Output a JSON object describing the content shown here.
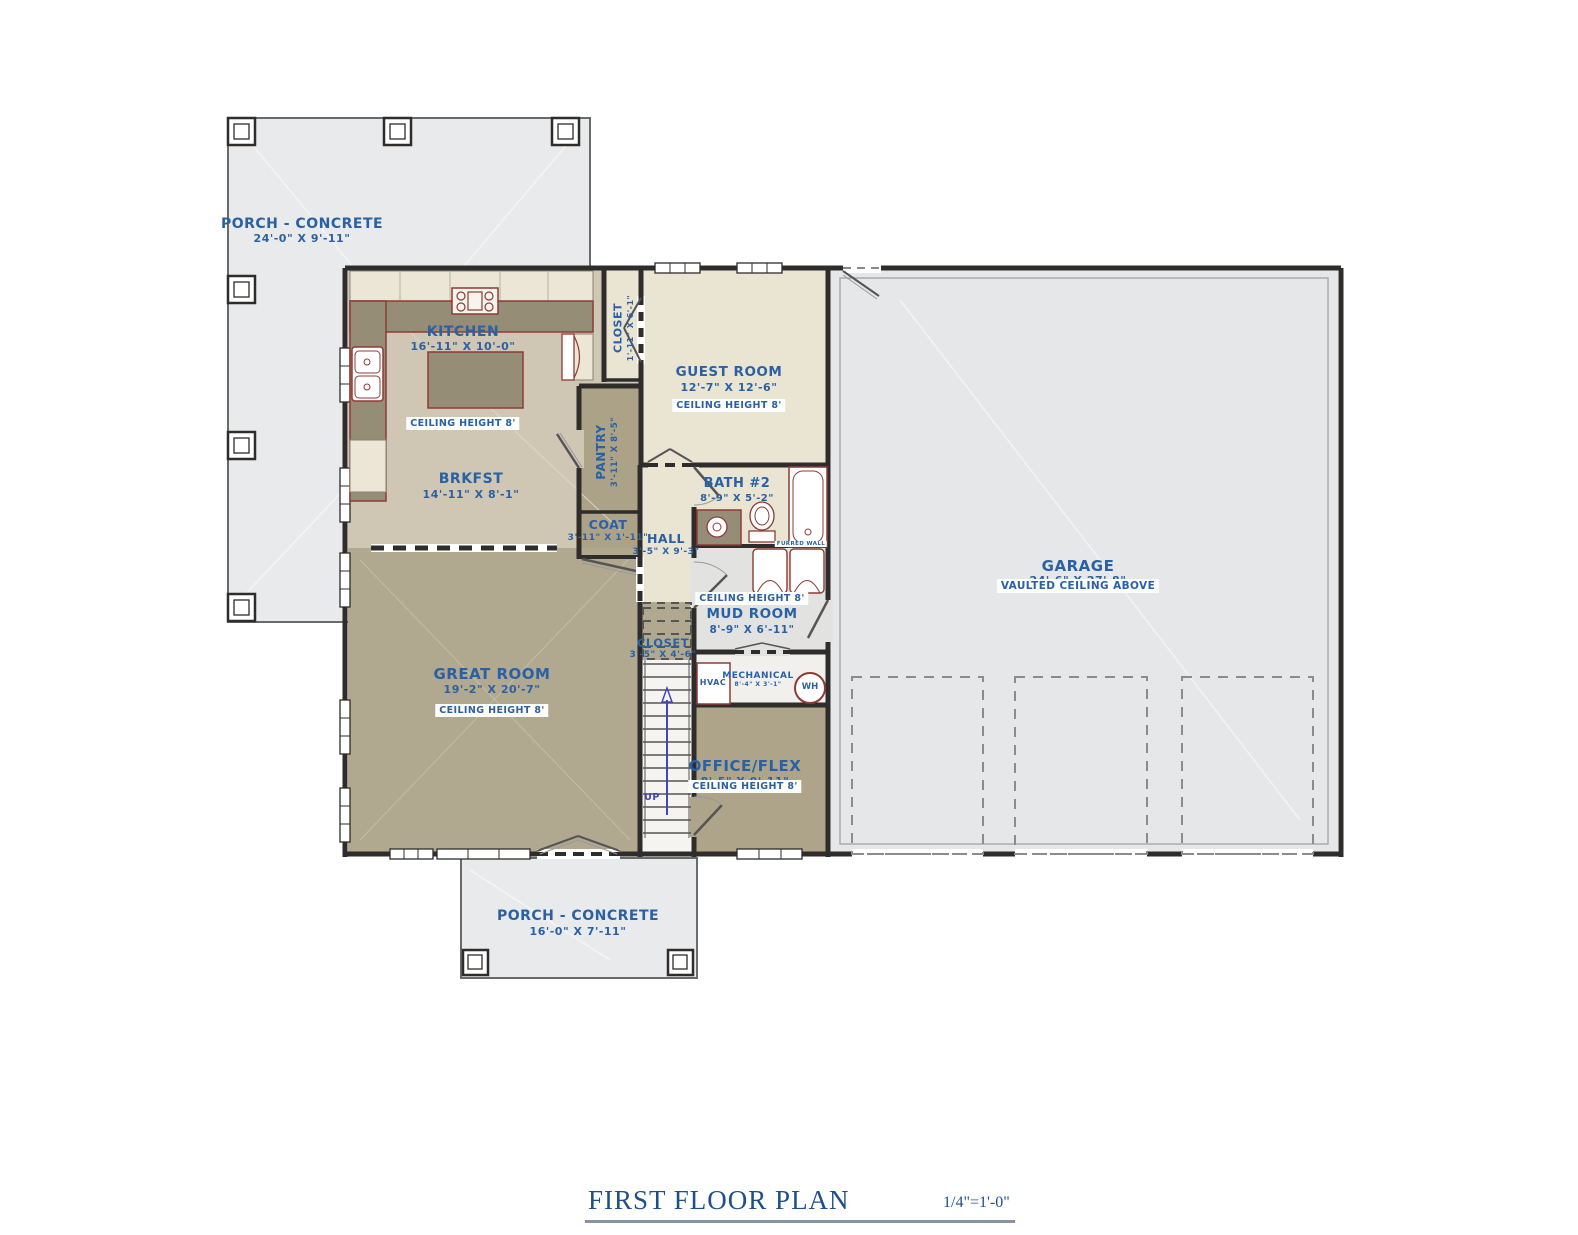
{
  "title": {
    "text": "FIRST FLOOR PLAN",
    "scale": "1/4\"=1'-0\""
  },
  "colors": {
    "label_blue": "#2a61a5",
    "title_navy": "#1d4f8f",
    "wall": "#2e2d2b",
    "fixture_red": "#8e3b34",
    "floor_tan_dark": "#b1a890",
    "floor_tan_light": "#cfc7b4",
    "floor_cream": "#eae4d3",
    "cabinet_cream": "#ece6d6",
    "counter_olive": "#968d77",
    "porch_gray": "#e8eaeb",
    "garage_gray": "#e6e7e8",
    "mud_gray": "#e2e2e1"
  },
  "labels": {
    "porch_top": {
      "name": "PORCH - CONCRETE",
      "dim": "24'-0\" X 9'-11\""
    },
    "kitchen": {
      "name": "KITCHEN",
      "dim": "16'-11\" X 10'-0\"",
      "ceiling": "CEILING HEIGHT 8'"
    },
    "closet_kitchen": {
      "name": "CLOSET",
      "dim": "1'-11\" X 6'-1\""
    },
    "guest_room": {
      "name": "GUEST ROOM",
      "dim": "12'-7\" X 12'-6\"",
      "ceiling": "CEILING HEIGHT 8'"
    },
    "pantry": {
      "name": "PANTRY",
      "dim": "3'-11\" X 8'-5\""
    },
    "brkfst": {
      "name": "BRKFST",
      "dim": "14'-11\" X 8'-1\""
    },
    "bath2": {
      "name": "BATH #2",
      "dim": "8'-9\" X 5'-2\""
    },
    "coat": {
      "name": "COAT",
      "dim": "3'-11\" X 1'-11\""
    },
    "hall": {
      "name": "HALL",
      "dim": "3'-5\" X 9'-3\""
    },
    "furred_wall": {
      "name": "FURRED WALL"
    },
    "garage": {
      "name": "GARAGE",
      "dim": "24'-6\" X 27'-8\"",
      "note": "VAULTED CEILING ABOVE"
    },
    "mud_room": {
      "name": "MUD ROOM",
      "dim": "8'-9\" X 6'-11\"",
      "ceiling": "CEILING HEIGHT 8'"
    },
    "great_room": {
      "name": "GREAT ROOM",
      "dim": "19'-2\" X 20'-7\"",
      "ceiling": "CEILING HEIGHT 8'"
    },
    "closet_stairs": {
      "name": "CLOSET",
      "dim": "3'-5\" X 4'-6\""
    },
    "hvac": {
      "name": "HVAC"
    },
    "mechanical": {
      "name": "MECHANICAL",
      "dim": "8'-4\" X 3'-1\""
    },
    "wh": {
      "name": "WH"
    },
    "office": {
      "name": "OFFICE/FLEX",
      "dim": "8'-5\" X 9'-11\"",
      "ceiling": "CEILING HEIGHT 8'"
    },
    "stairs": {
      "up": "UP"
    },
    "porch_bottom": {
      "name": "PORCH - CONCRETE",
      "dim": "16'-0\" X 7'-11\""
    }
  }
}
